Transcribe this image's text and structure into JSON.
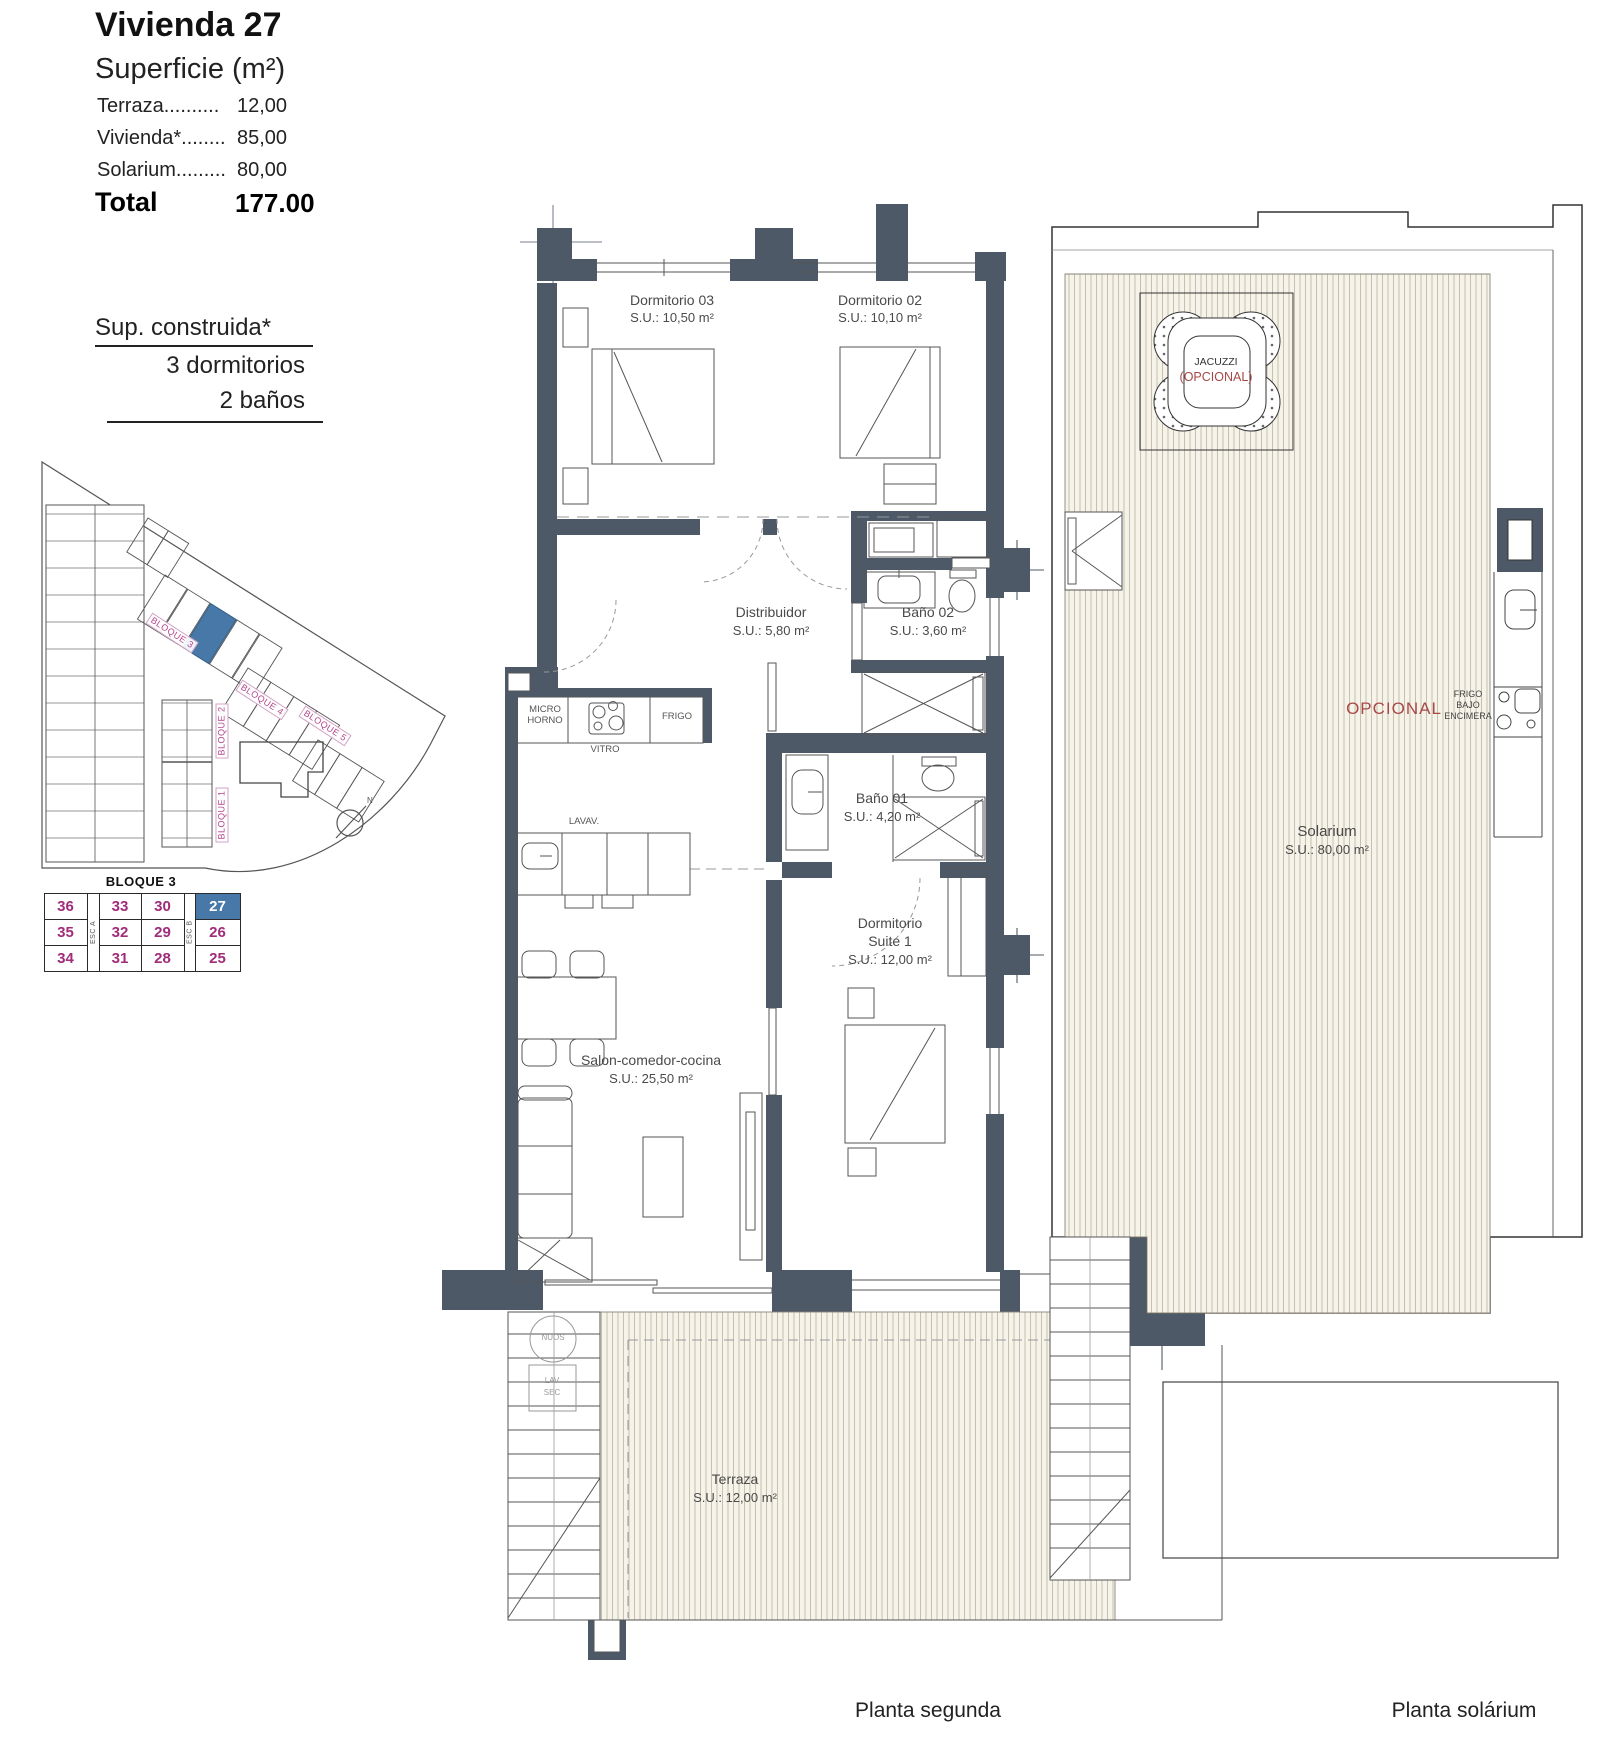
{
  "header": {
    "title": "Vivienda 27",
    "subtitle": "Superficie (m²)",
    "rows": [
      {
        "label": "Terraza..........",
        "value": "12,00"
      },
      {
        "label": "Vivienda*........",
        "value": "85,00"
      },
      {
        "label": "Solarium.........",
        "value": "80,00"
      }
    ],
    "total_label": "Total",
    "total_value": "177.00",
    "built_title": "Sup. construida*",
    "built_line1": "3 dormitorios",
    "built_line2": "2 baños"
  },
  "site_plan": {
    "block1": "BLOQUE 1",
    "block2": "BLOQUE 2",
    "block3": "BLOQUE 3",
    "block4": "BLOQUE 4",
    "block5": "BLOQUE 5",
    "north": "N"
  },
  "block_table": {
    "title": "BLOQUE 3",
    "esc_a": "ESC A",
    "esc_b": "ESC B",
    "rows": [
      [
        "36",
        "33",
        "30",
        "27"
      ],
      [
        "35",
        "32",
        "29",
        "26"
      ],
      [
        "34",
        "31",
        "28",
        "25"
      ]
    ],
    "highlighted_unit": "27"
  },
  "rooms": {
    "dorm03": {
      "name": "Dormitorio 03",
      "area": "S.U.: 10,50 m²"
    },
    "dorm02": {
      "name": "Dormitorio 02",
      "area": "S.U.: 10,10 m²"
    },
    "distribuidor": {
      "name": "Distribuidor",
      "area": "S.U.: 5,80 m²"
    },
    "bano02": {
      "name": "Baño 02",
      "area": "S.U.: 3,60 m²"
    },
    "bano01": {
      "name": "Baño 01",
      "area": "S.U.: 4,20 m²"
    },
    "suite": {
      "name1": "Dormitorio",
      "name2": "Suite 1",
      "area": "S.U.: 12,00 m²"
    },
    "salon": {
      "name": "Salon-comedor-cocina",
      "area": "S.U.: 25,50 m²"
    },
    "terraza": {
      "name": "Terraza",
      "area": "S.U.: 12,00 m²"
    }
  },
  "fixtures": {
    "micro1": "MICRO",
    "micro2": "HORNO",
    "vitro": "VITRO",
    "frigo": "FRIGO",
    "lavav": "LAVAV.",
    "nuos": "NUOS",
    "lav1": "LAV",
    "lav2": "SEC"
  },
  "solarium": {
    "name": "Solarium",
    "area": "S.U.: 80,00 m²",
    "jacuzzi": "JACUZZI",
    "jacuzzi_opt": "(OPCIONAL)",
    "opcional": "OPCIONAL",
    "frigo1": "FRIGO",
    "frigo2": "BAJO",
    "frigo3": "ENCIMERA"
  },
  "captions": {
    "left": "Planta segunda",
    "right": "Planta solárium"
  },
  "colors": {
    "wall": "#4D5966",
    "highlight_blue": "#4878A8",
    "magenta": "#A02C7A",
    "label_pink": "#B3478F",
    "optional_red": "#A84848"
  }
}
